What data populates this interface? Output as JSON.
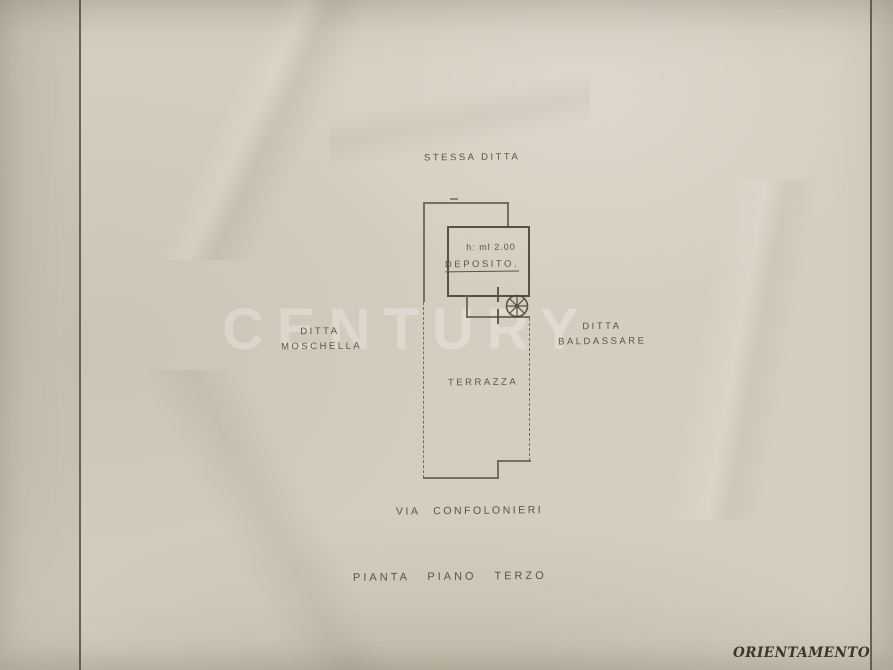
{
  "page": {
    "watermark": "CENTURY"
  },
  "plan": {
    "top_label": "STESSA DITTA",
    "room_height_note": "h: ml 2.00",
    "room_label": "DEPOSITO.",
    "terrace_label": "TERRAZZA",
    "left_neighbor": {
      "line1": "DITTA",
      "line2": "MOSCHELLA"
    },
    "right_neighbor": {
      "line1": "DITTA",
      "line2": "BALDASSARE"
    },
    "street_label": "VIA CONFOLONIERI",
    "caption": "PIANTA PIANO TERZO"
  },
  "form": {
    "orientation_label": "ORIENTAMENTO"
  },
  "colors": {
    "paper": "#d5cec0",
    "pencil": "#6a6150",
    "wall": "#4c4635",
    "handwriting": "#5b5444",
    "print_text": "#39352b",
    "form_rule": "#56503f"
  }
}
